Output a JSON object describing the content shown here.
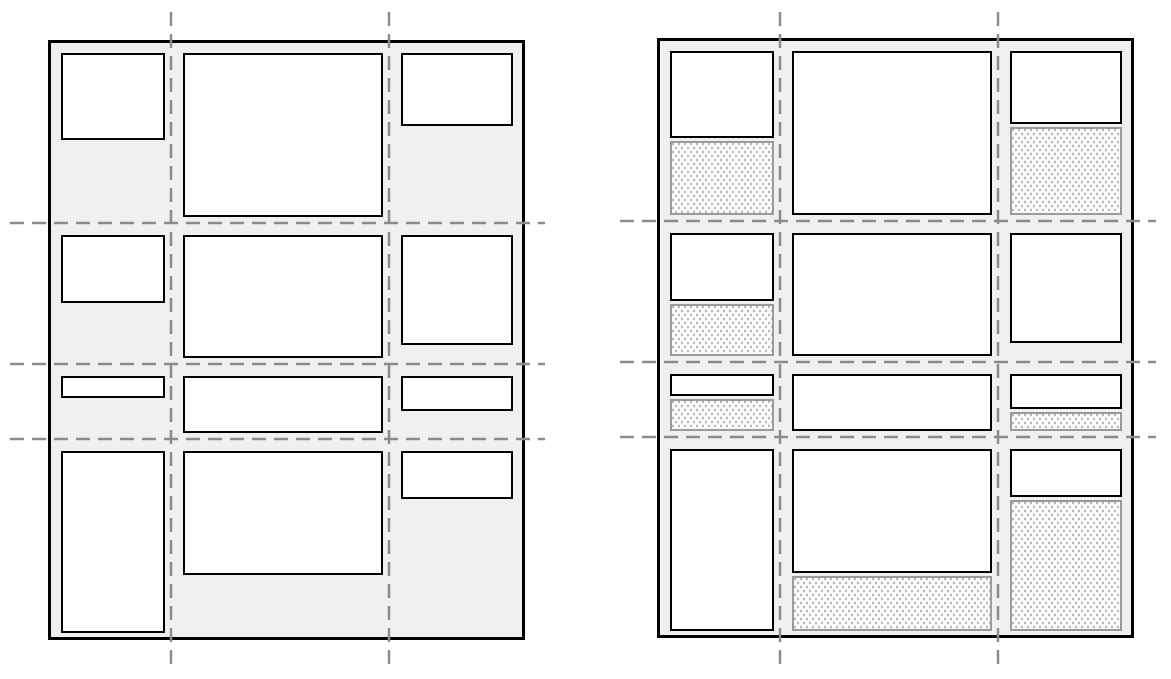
{
  "canvas": {
    "width": 1171,
    "height": 679,
    "background": "#ffffff"
  },
  "colors": {
    "canvas_bg": "#ffffff",
    "container_bg": "#f0f0f0",
    "container_border": "#000000",
    "box_bg": "#ffffff",
    "box_border": "#000000",
    "grid_line": "#8c8c8c",
    "dotted_bg": "#fcfcfc",
    "dotted_border": "#9a9a9a",
    "dot_color": "#b4b4b4"
  },
  "grid_template": {
    "columns": [
      104,
      200,
      112
    ],
    "rows": [
      164,
      123,
      57,
      182
    ],
    "gap": 18,
    "padding": 10,
    "container_border_width": 3,
    "box_border_width": 2
  },
  "box_heights": [
    [
      87,
      164,
      73
    ],
    [
      68,
      123,
      110
    ],
    [
      22,
      57,
      35
    ],
    [
      182,
      124,
      48
    ]
  ],
  "panels": [
    {
      "id": "grid-diagram-plain",
      "x": 48,
      "y": 40,
      "width": 477,
      "height": 600,
      "dotted_cells": [
        [
          false,
          false,
          false
        ],
        [
          false,
          false,
          false
        ],
        [
          false,
          false,
          false
        ],
        [
          false,
          false,
          false
        ]
      ]
    },
    {
      "id": "grid-diagram-stretched",
      "x": 657,
      "y": 38,
      "width": 477,
      "height": 600,
      "dotted_cells": [
        [
          true,
          false,
          true
        ],
        [
          true,
          false,
          false
        ],
        [
          true,
          false,
          true
        ],
        [
          false,
          true,
          true
        ]
      ]
    }
  ],
  "grid_lines": {
    "stroke": "#8c8c8c",
    "stroke_width": 2.5,
    "dash_pattern": "14 8",
    "vertical_extent_y": [
      12,
      672
    ],
    "horizontal_extent_x": {
      "grid-diagram-plain": [
        10,
        545
      ],
      "grid-diagram-stretched": [
        620,
        1156
      ]
    }
  }
}
